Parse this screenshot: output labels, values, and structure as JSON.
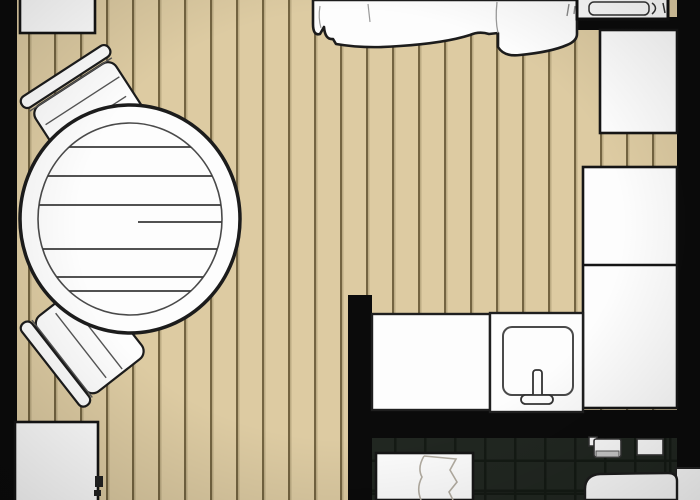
{
  "scene": {
    "kind": "studio-apartment-floor-plan",
    "width": 700,
    "height": 500,
    "visible_text": "none"
  },
  "colors": {
    "wall": "#0b0b0b",
    "outline": "#1c1c1c",
    "floor": "#ddcba2",
    "floor_line": "#8a7b58",
    "furniture_white": "#fdfdfd",
    "sketch_line": "#3a3a3a",
    "tile": "#212721",
    "tile_grout": "#141a14",
    "soft_sketch": "#b3ada2"
  },
  "rooms": [
    {
      "name": "living-area",
      "flooring": "wood-planks"
    },
    {
      "name": "kitchenette",
      "flooring": "wood-planks"
    },
    {
      "name": "bathroom",
      "flooring": "dark-tile"
    }
  ],
  "walls": [
    {
      "name": "exterior-wall-left"
    },
    {
      "name": "exterior-wall-right"
    },
    {
      "name": "partition-wall-vertical"
    },
    {
      "name": "partition-wall-bathroom"
    },
    {
      "name": "headboard-wall-segment"
    }
  ],
  "furniture": [
    {
      "name": "shelf-top-left",
      "room": "living-area"
    },
    {
      "name": "round-dining-table",
      "room": "living-area",
      "style": "wood-plank-top"
    },
    {
      "name": "chair-upper",
      "room": "living-area"
    },
    {
      "name": "chair-lower",
      "room": "living-area"
    },
    {
      "name": "bed-with-duvet",
      "room": "living-area",
      "note": "cut off at top edge"
    },
    {
      "name": "pillow-nook",
      "room": "living-area"
    },
    {
      "name": "wardrobe-right-top",
      "room": "living-area"
    },
    {
      "name": "closet-right-upper",
      "room": "living-area"
    },
    {
      "name": "closet-right-lower",
      "room": "kitchenette"
    },
    {
      "name": "kitchen-counter",
      "room": "kitchenette"
    },
    {
      "name": "kitchen-sink-counter",
      "room": "kitchenette"
    },
    {
      "name": "sink-basin-with-faucet",
      "room": "kitchenette"
    },
    {
      "name": "cabinet-bottom-left",
      "room": "living-area"
    },
    {
      "name": "shower-door-panel",
      "room": "bathroom"
    },
    {
      "name": "toilet",
      "room": "bathroom"
    },
    {
      "name": "toilet-paper-holder",
      "room": "bathroom"
    },
    {
      "name": "bathroom-shelf",
      "room": "bathroom"
    }
  ]
}
